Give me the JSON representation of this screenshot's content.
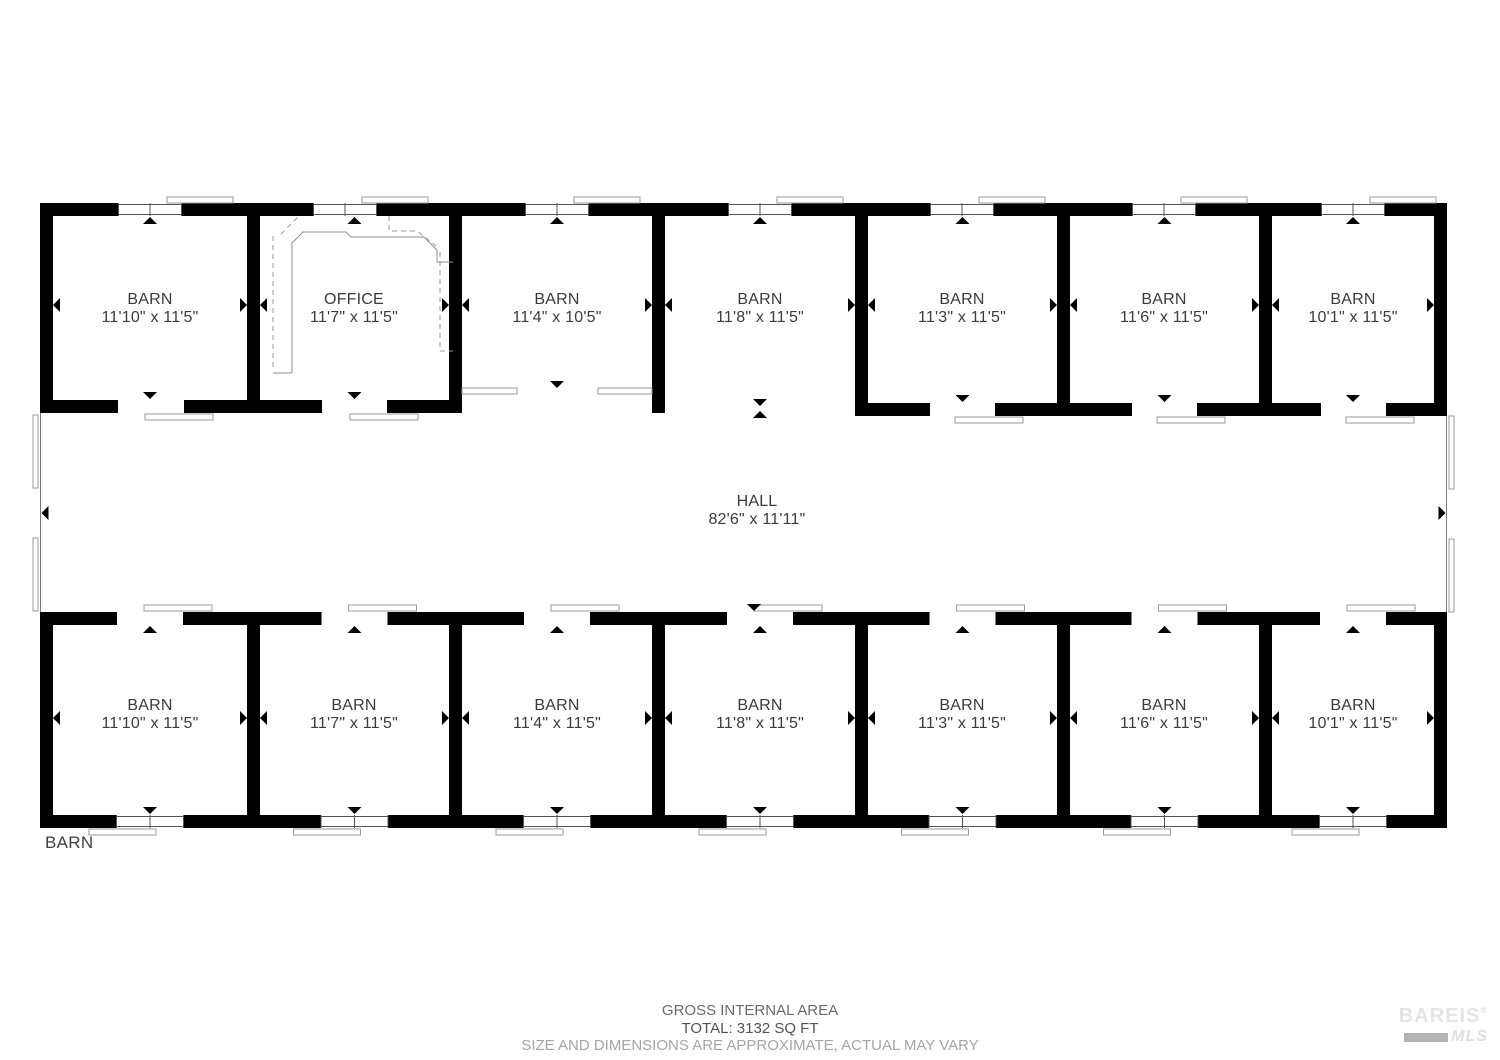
{
  "plan": {
    "top_rooms": [
      {
        "name": "BARN",
        "dims": "11'10\" x 11'5\""
      },
      {
        "name": "OFFICE",
        "dims": "11'7\" x 11'5\""
      },
      {
        "name": "BARN",
        "dims": "11'4\" x 10'5\""
      },
      {
        "name": "BARN",
        "dims": "11'8\" x 11'5\""
      },
      {
        "name": "BARN",
        "dims": "11'3\" x 11'5\""
      },
      {
        "name": "BARN",
        "dims": "11'6\" x 11'5\""
      },
      {
        "name": "BARN",
        "dims": "10'1\" x 11'5\""
      }
    ],
    "hall": {
      "name": "HALL",
      "dims": "82'6\" x 11'11\""
    },
    "bottom_rooms": [
      {
        "name": "BARN",
        "dims": "11'10\" x 11'5\""
      },
      {
        "name": "BARN",
        "dims": "11'7\" x 11'5\""
      },
      {
        "name": "BARN",
        "dims": "11'4\" x 11'5\""
      },
      {
        "name": "BARN",
        "dims": "11'8\" x 11'5\""
      },
      {
        "name": "BARN",
        "dims": "11'3\" x 11'5\""
      },
      {
        "name": "BARN",
        "dims": "11'6\" x 11'5\""
      },
      {
        "name": "BARN",
        "dims": "10'1\" x 11'5\""
      }
    ],
    "floor_label": "BARN"
  },
  "footer": {
    "area_title": "GROSS INTERNAL AREA",
    "total": "TOTAL: 3132 SQ FT",
    "disclaimer": "SIZE AND DIMENSIONS ARE APPROXIMATE, ACTUAL MAY VARY"
  },
  "watermark": {
    "line1": "BAREIS",
    "reg": "®",
    "line2": "MLS"
  },
  "icons": {
    "measure_arrow_up": "▲",
    "measure_arrow_down": "▼",
    "measure_arrow_left": "◄",
    "measure_arrow_right": "►"
  },
  "colors": {
    "wall": "#000000",
    "thin_line": "#8a8a8a",
    "room_label": "#3b3b3b",
    "footer_dark": "#525252",
    "footer_muted": "#a5a5a5",
    "watermark": "#e4e4e4",
    "watermark_bar": "#b3b3b3"
  }
}
